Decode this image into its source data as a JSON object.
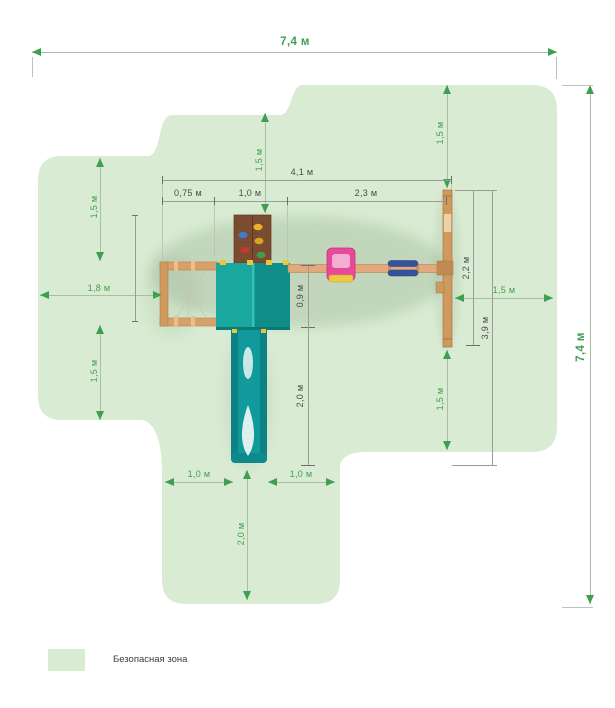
{
  "legend": {
    "safe_zone_label": "Безопасная зона"
  },
  "dims": {
    "top_width": "7,4 м",
    "right_height": "7,4 м",
    "top_center_clearance": "1,5 м",
    "top_right_clearance": "1,5 м",
    "left_upper_clearance": "1,5 м",
    "left_clearance": "1,8 м",
    "left_lower_clearance": "1,5 м",
    "right_clearance": "1,5 м",
    "right_lower_clearance": "1,5 м",
    "structure_width": "4,1 м",
    "frame_section_width": "0,75 м",
    "tower_width": "1,0 м",
    "beam_length": "2,3 м",
    "tower_depth": "0,9 м",
    "slide_length": "2,0 м",
    "swing_post_length": "2,2 м",
    "structure_depth": "3,9 м",
    "bottom_left_clearance": "1,0 м",
    "bottom_right_clearance": "1,0 м",
    "bottom_clearance": "2,0 м"
  },
  "colors": {
    "zone": "#d9ecd3",
    "dg": "#3f9e52",
    "dgl": "#a7bfa7",
    "sg": "#4a4a4a",
    "sgl": "#9b9b9b"
  }
}
